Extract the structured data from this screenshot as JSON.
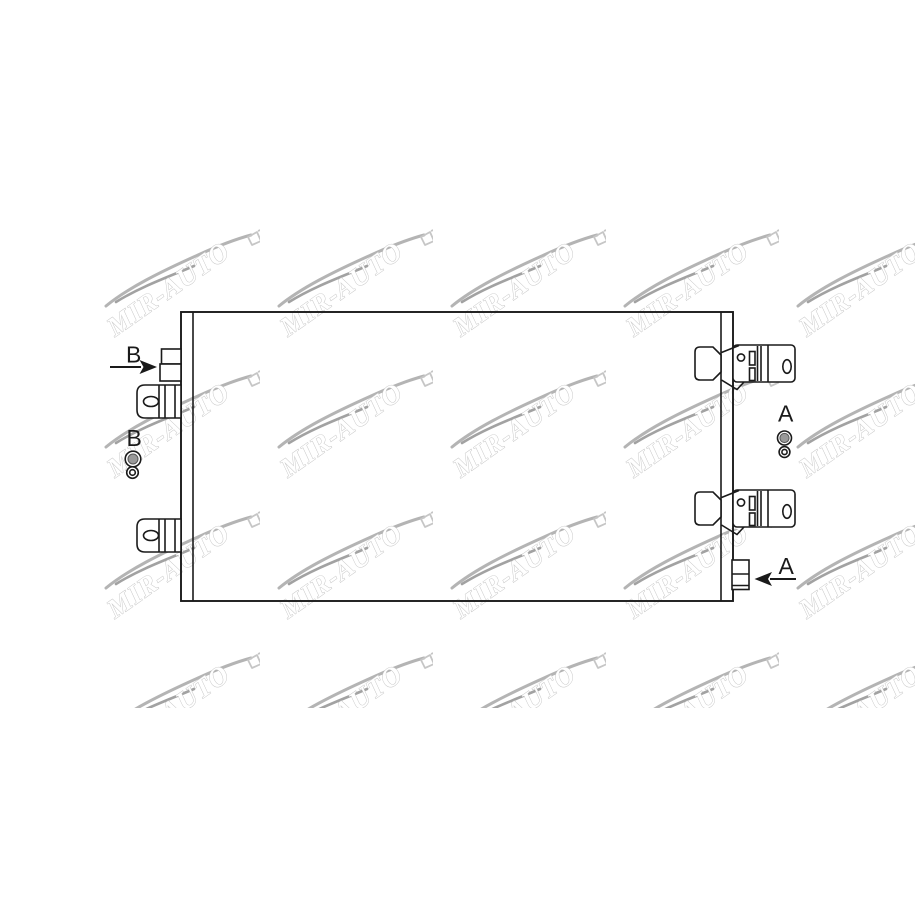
{
  "diagram": {
    "type": "technical-line-drawing",
    "subject": "air-conditioning condenser, front view with mounting brackets and port fittings",
    "labels": {
      "port_b_top": "B",
      "port_b_valve": "B",
      "port_a_valve": "A",
      "port_a_bottom": "A"
    }
  },
  "watermark": {
    "text": "MIR-AUTO",
    "rows": [
      224,
      365,
      506,
      647
    ],
    "cols": [
      102,
      275,
      448,
      621,
      794
    ]
  },
  "colors": {
    "line": "#1a1a1a",
    "bg": "#ffffff",
    "valve": "#999999",
    "swoosh1": "#b4b4b4",
    "swoosh2": "#a2a2a2",
    "hook": "#c6c6c6",
    "wmstroke": "#c2c2c2"
  }
}
